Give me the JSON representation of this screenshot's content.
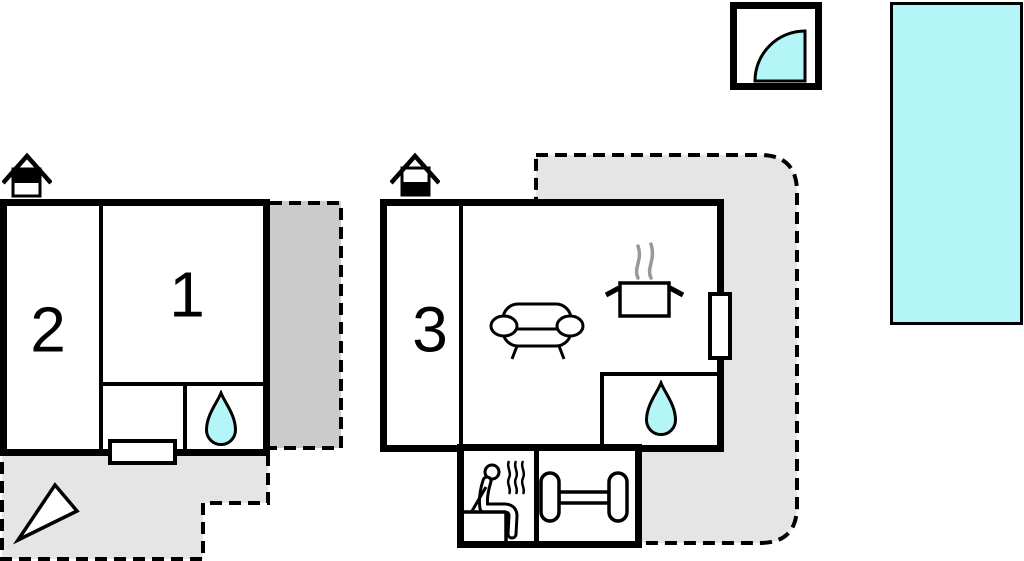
{
  "plan": {
    "type": "vacation-home-floor-plan",
    "rooms": {
      "room1": {
        "label": "1"
      },
      "room2": {
        "label": "2"
      },
      "room3": {
        "label": "3"
      }
    },
    "areas": [
      {
        "name": "left-building",
        "story_icon": "house-upper-floor",
        "features": [
          "bedroom-1",
          "bedroom-2",
          "bathroom-water-drop",
          "entrance-door",
          "terrace-dashed",
          "stairs-arrow"
        ]
      },
      {
        "name": "main-building",
        "story_icon": "house-ground-floor",
        "features": [
          "room-3",
          "living-area-sofa",
          "kitchen-pot-steam",
          "bathroom-water-drop",
          "door-right-wall",
          "sauna",
          "gym-dumbbell",
          "wraparound-terrace-dashed"
        ]
      },
      {
        "name": "outdoor",
        "features": [
          "shower-quarter-circle",
          "swimming-pool"
        ]
      }
    ],
    "icons": [
      "house-upper-floor",
      "house-ground-floor",
      "water-drop",
      "sofa",
      "cooking-pot",
      "steam",
      "sauna-person",
      "dumbbell",
      "stairs-arrow",
      "shower-quarter",
      "pool"
    ],
    "colors": {
      "water": "#b4f6f8",
      "terrace": "#e5e5e5",
      "covered_terrace": "#cbcbcb",
      "wall": "#000000",
      "steam_gray": "#999999"
    }
  }
}
